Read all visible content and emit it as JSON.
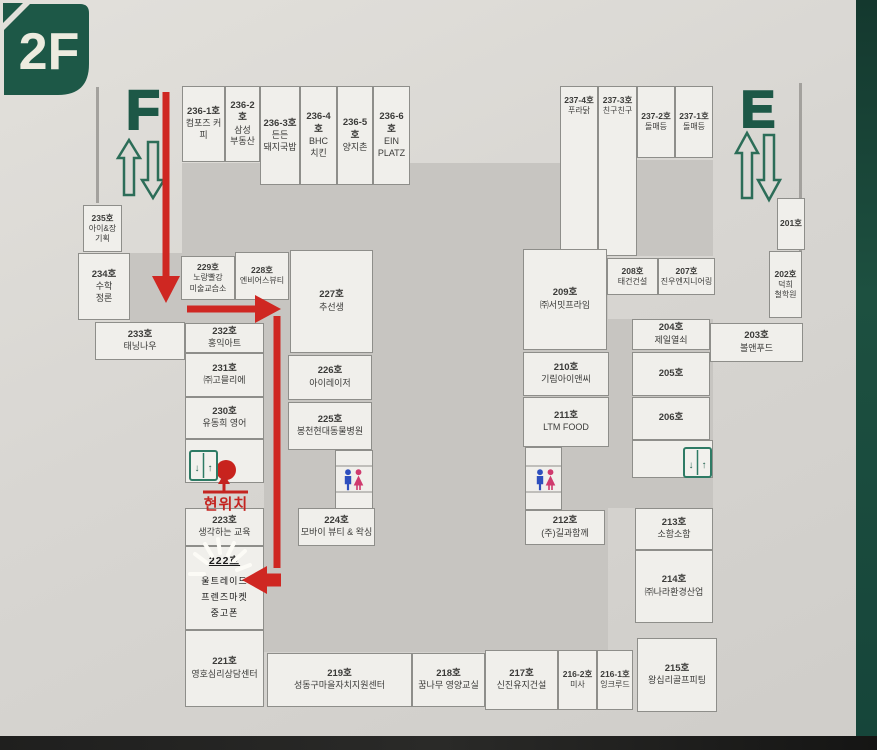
{
  "labels": {
    "floor_badge": "2F",
    "stair_f": "F",
    "stair_e": "E",
    "here": "현위치",
    "elev_down": "↓",
    "elev_up": "↑"
  },
  "colors": {
    "green": "#1d5847",
    "red": "#cf2722",
    "core_gray": "#c7c5c1",
    "room_white": "#f0efeb"
  },
  "rooms": {
    "r236_1": {
      "no": "236-1호",
      "name": "컴포즈 커피"
    },
    "r236_2": {
      "no": "236-2호",
      "name": "삼성\n부동산"
    },
    "r236_3": {
      "no": "236-3호",
      "name": "든든\n돼지국밥"
    },
    "r236_4": {
      "no": "236-4호",
      "name": "BHC\n치킨"
    },
    "r236_5": {
      "no": "236-5호",
      "name": "양지촌"
    },
    "r236_6": {
      "no": "236-6호",
      "name": "EIN\nPLATZ"
    },
    "r237_4": {
      "no": "237-4호",
      "name": "푸라닭"
    },
    "r237_3": {
      "no": "237-3호",
      "name": "친구친구"
    },
    "r237_2": {
      "no": "237-2호",
      "name": "돌매등"
    },
    "r237_1": {
      "no": "237-1호",
      "name": "돌매등"
    },
    "r235": {
      "no": "235호",
      "name": "아이&장\n기획"
    },
    "r234": {
      "no": "234호",
      "name": "수학\n정론"
    },
    "r233": {
      "no": "233호",
      "name": "태닝나우"
    },
    "r232": {
      "no": "232호",
      "name": "홍익아트"
    },
    "r231": {
      "no": "231호",
      "name": "㈜고믈리에"
    },
    "r230": {
      "no": "230호",
      "name": "유동희 영어"
    },
    "r229": {
      "no": "229호",
      "name": "노랑빨강\n미술교습소"
    },
    "r228": {
      "no": "228호",
      "name": "엔비어스뷰티"
    },
    "r227": {
      "no": "227호",
      "name": "추선생"
    },
    "r226": {
      "no": "226호",
      "name": "아이레이저"
    },
    "r225": {
      "no": "225호",
      "name": "봉천현대동물병원"
    },
    "r224": {
      "no": "224호",
      "name": "모바이 뷰티 & 왁싱"
    },
    "r223": {
      "no": "223호",
      "name": "생각하는 교육"
    },
    "r222": {
      "no": "222호",
      "name": "울트레이드\n프렌즈마켓\n중고폰"
    },
    "r221": {
      "no": "221호",
      "name": "영호심리상담센터"
    },
    "r219": {
      "no": "219호",
      "name": "성동구마을자치지원센터"
    },
    "r218": {
      "no": "218호",
      "name": "꿈나무 영양교실"
    },
    "r217": {
      "no": "217호",
      "name": "신진유지건설"
    },
    "r216_2": {
      "no": "216-2호",
      "name": "미사"
    },
    "r216_1": {
      "no": "216-1호",
      "name": "잉크루드"
    },
    "r215": {
      "no": "215호",
      "name": "왕십리골프피팅"
    },
    "r214": {
      "no": "214호",
      "name": "㈜나라환경산업"
    },
    "r213": {
      "no": "213호",
      "name": "소함소함"
    },
    "r212": {
      "no": "212호",
      "name": "(주)길과함께"
    },
    "r211": {
      "no": "211호",
      "name": "LTM FOOD"
    },
    "r210": {
      "no": "210호",
      "name": "기림아이앤씨"
    },
    "r209": {
      "no": "209호",
      "name": "㈜서밋프라임"
    },
    "r208": {
      "no": "208호",
      "name": "태건건설"
    },
    "r207": {
      "no": "207호",
      "name": "진우엔지니어링"
    },
    "r206": {
      "no": "206호",
      "name": ""
    },
    "r205": {
      "no": "205호",
      "name": ""
    },
    "r204": {
      "no": "204호",
      "name": "제일열쇠"
    },
    "r203": {
      "no": "203호",
      "name": "볼앤푸드"
    },
    "r202": {
      "no": "202호",
      "name": "덕희\n철학원"
    },
    "r201": {
      "no": "201호",
      "name": ""
    }
  }
}
